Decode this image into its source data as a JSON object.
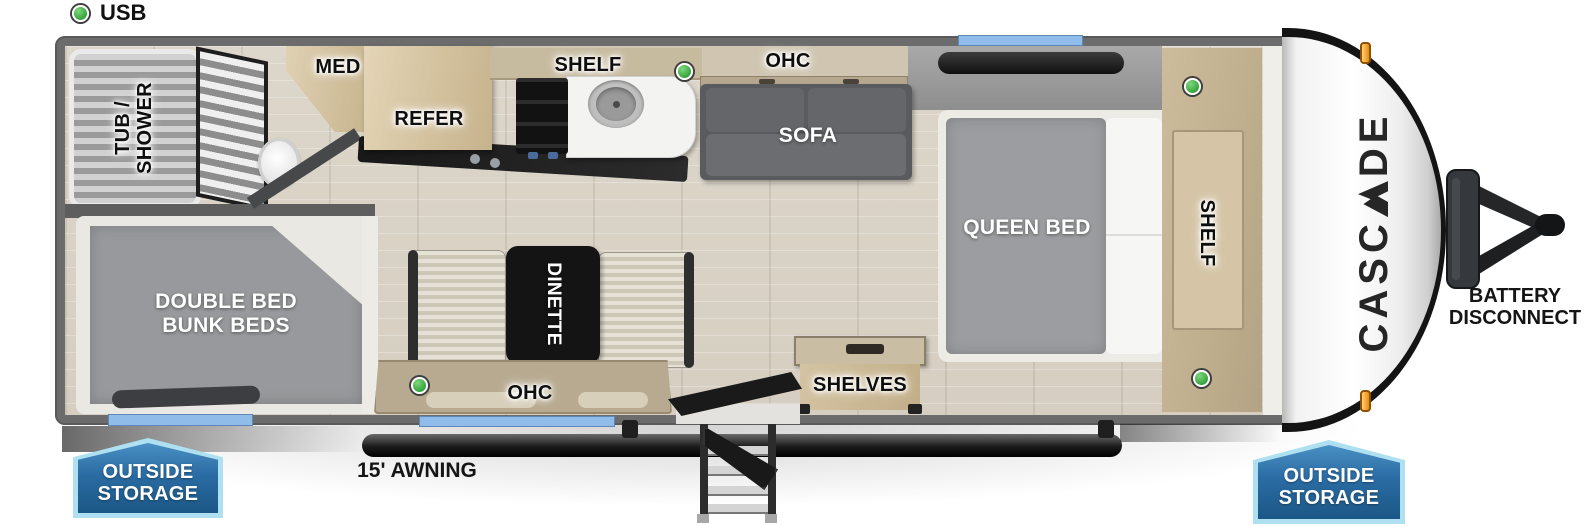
{
  "legend": {
    "usb": "USB"
  },
  "labels": {
    "tub_line1": "TUB /",
    "tub_line2": "SHOWER",
    "med": "MED",
    "refer": "REFER",
    "kitchen_shelf": "SHELF",
    "living_ohc": "OHC",
    "sofa": "SOFA",
    "queen_bed": "QUEEN BED",
    "bedroom_shelf": "SHELF",
    "bunk_line1": "DOUBLE BED",
    "bunk_line2": "BUNK BEDS",
    "dinette": "DINETTE",
    "dinette_ohc": "OHC",
    "shelves": "SHELVES"
  },
  "exterior": {
    "brand_prefix": "CASC",
    "brand_suffix": "DE",
    "battery_line1": "BATTERY",
    "battery_line2": "DISCONNECT",
    "awning": "15' AWNING",
    "storage_left_line1": "OUTSIDE",
    "storage_left_line2": "STORAGE",
    "storage_right_line1": "OUTSIDE",
    "storage_right_line2": "STORAGE"
  },
  "markers": {
    "usb_marker_color": "#44b54a",
    "window_color": "#8fbce9",
    "badge_color": "#2a6ca3",
    "clearance_light_color": "#ef8c07"
  }
}
